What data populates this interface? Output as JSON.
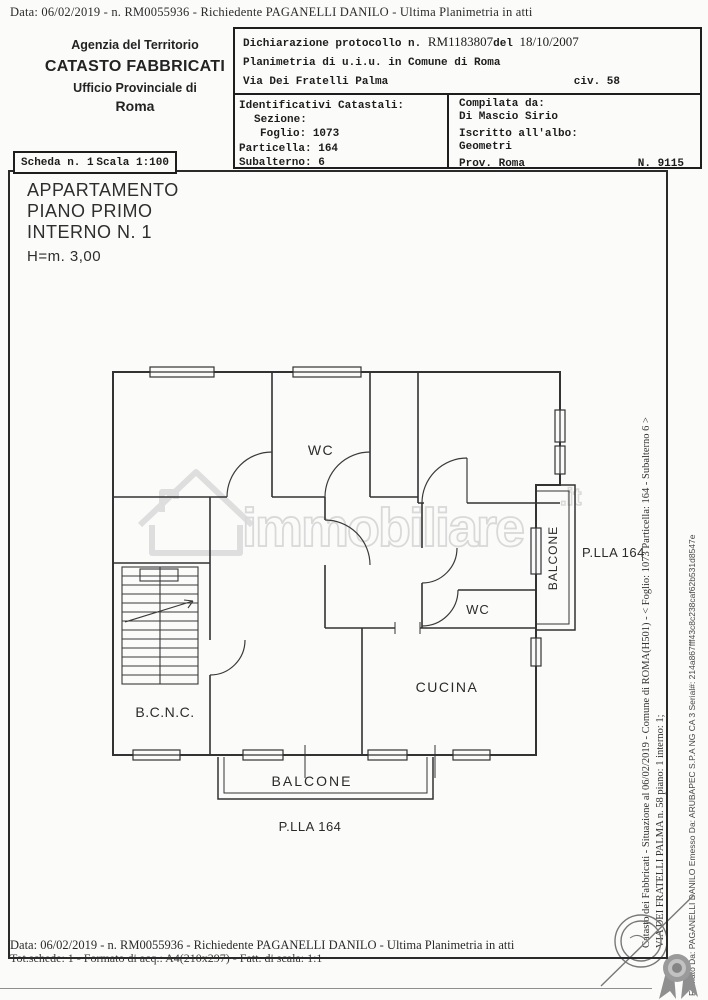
{
  "colors": {
    "ink": "#1d1d1d",
    "paper": "#fbfbf9",
    "watermark": "#d6d6d6",
    "stamp": "#787878",
    "rosette": "#8f8f8f"
  },
  "top_bar": {
    "text": "Data: 06/02/2019 - n. RM0055936 - Richiedente PAGANELLI DANILO - Ultima Planimetria in atti"
  },
  "agency": {
    "line1": "Agenzia del Territorio",
    "line2": "CATASTO FABBRICATI",
    "line3": "Ufficio Provinciale di",
    "line4": "Roma"
  },
  "declaration": {
    "label": "Dichiarazione protocollo n.",
    "number": "RM1183807",
    "del_word": "del",
    "date": "18/10/2007",
    "object_line": "Planimetria di u.i.u. in Comune di Roma",
    "street": "Via Dei Fratelli Palma",
    "civic": "civ. 58"
  },
  "identifiers": {
    "title": "Identificativi Catastali:",
    "sezione_label": "Sezione:",
    "sezione_value": "",
    "foglio_label": "Foglio:",
    "foglio_value": "1073",
    "particella_label": "Particella:",
    "particella_value": "164",
    "subalterno_label": "Subalterno:",
    "subalterno_value": "6"
  },
  "compiler": {
    "title": "Compilata da:",
    "name": "Di Mascio Sirio",
    "albo_label": "Iscritto all'albo:",
    "albo_value": "Geometri",
    "prov": "Prov. Roma",
    "reg_number": "N. 9115"
  },
  "scheda": {
    "number": "Scheda n. 1",
    "scale": "Scala 1:100"
  },
  "apartment": {
    "line1": "APPARTAMENTO",
    "line2": "PIANO PRIMO",
    "line3": "INTERNO N. 1",
    "height": "H=m. 3,00"
  },
  "rooms": {
    "wc_top": "WC",
    "wc_bottom": "WC",
    "kitchen": "CUCINA",
    "bcnc": "B.C.N.C.",
    "balcony_bottom": "BALCONE",
    "balcony_right": "BALCONE",
    "parcel_right": "P.LLA 164",
    "parcel_bottom": "P.LLA 164"
  },
  "watermark": {
    "brand": "immobiliare",
    "tld": ".it"
  },
  "signature": {
    "catasto_line1": "Catasto dei Fabbricati - Situazione al 06/02/2019 - Comune di ROMA(H501) - < Foglio: 1073 Particella: 164 - Subalterno 6 >",
    "catasto_line2": "VIA DEI FRATELLI PALMA n. 58 piano: 1 interno: 1;",
    "firmato": "Firmato Da: PAGANELLI DANILO Emesso Da: ARUBAPEC S.P.A NG CA 3 Serial#: 214a867fff43c8c238caf62b531d8547e"
  },
  "bottom_bar": {
    "line1": "Data: 06/02/2019 - n. RM0055936 - Richiedente PAGANELLI DANILO - Ultima Planimetria in atti",
    "line2": "Tot.schede: 1 - Formato di acq.: A4(210x297) - Fatt. di scala: 1:1"
  }
}
